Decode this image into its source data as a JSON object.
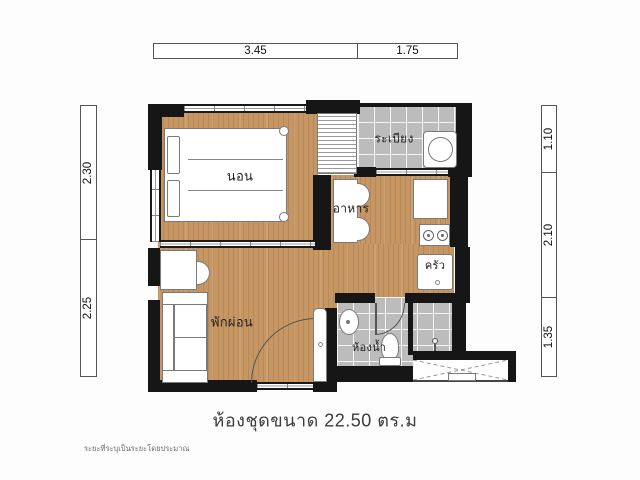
{
  "title": "ห้องชุดขนาด 22.50 ตร.ม",
  "area_sqm": "22.50",
  "footnote": "ระยะที่ระบุเป็นระยะโดยประมาณ",
  "rooms": {
    "bedroom": "นอน",
    "balcony": "ระเบียง",
    "dining": "อาหาร",
    "kitchen": "ครัว",
    "living": "พักผ่อน",
    "bathroom": "ห้องน้ำ"
  },
  "dims": {
    "top": [
      "3.45",
      "1.75"
    ],
    "left": [
      "2.30",
      "2.25"
    ],
    "right": [
      "1.10",
      "2.10",
      "1.35"
    ]
  },
  "colors": {
    "wall": "#161616",
    "wood": "#c69763",
    "tile": "#bcbcbc"
  }
}
